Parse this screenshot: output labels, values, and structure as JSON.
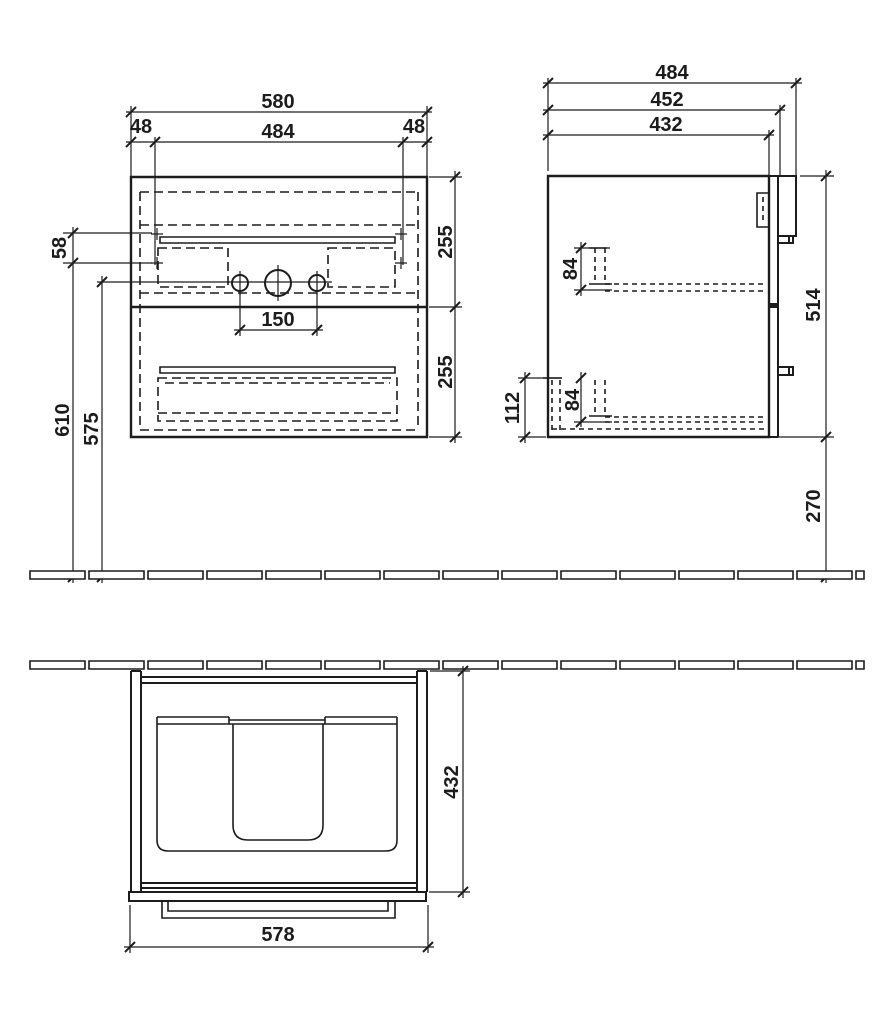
{
  "colors": {
    "ink": "#1c1c1c",
    "paper": "#ffffff"
  },
  "drawing": {
    "kind": "furniture-installation-drawing",
    "unit": "mm"
  },
  "views": {
    "front": {
      "label": "front-elevation",
      "dims": {
        "overall_width": "580",
        "left_side_panel": "48",
        "right_side_panel": "48",
        "inner_width": "484",
        "upper_drawer_height": "255",
        "lower_drawer_height": "255",
        "rail_hole_spacing": "58",
        "tap_hole_spacing": "150",
        "rail_height_from_floor": "610",
        "tap_height_from_floor": "575"
      }
    },
    "side": {
      "label": "side-elevation",
      "dims": {
        "overall_depth": "484",
        "depth_with_front": "452",
        "carcass_depth": "432",
        "carcass_height": "514",
        "floor_clearance": "270",
        "upper_rail_offset": "84",
        "lower_rail_offset": "84",
        "back_recess_height": "112"
      }
    },
    "plan": {
      "label": "top-view",
      "dims": {
        "carcass_depth": "432",
        "front_width": "578"
      }
    }
  }
}
